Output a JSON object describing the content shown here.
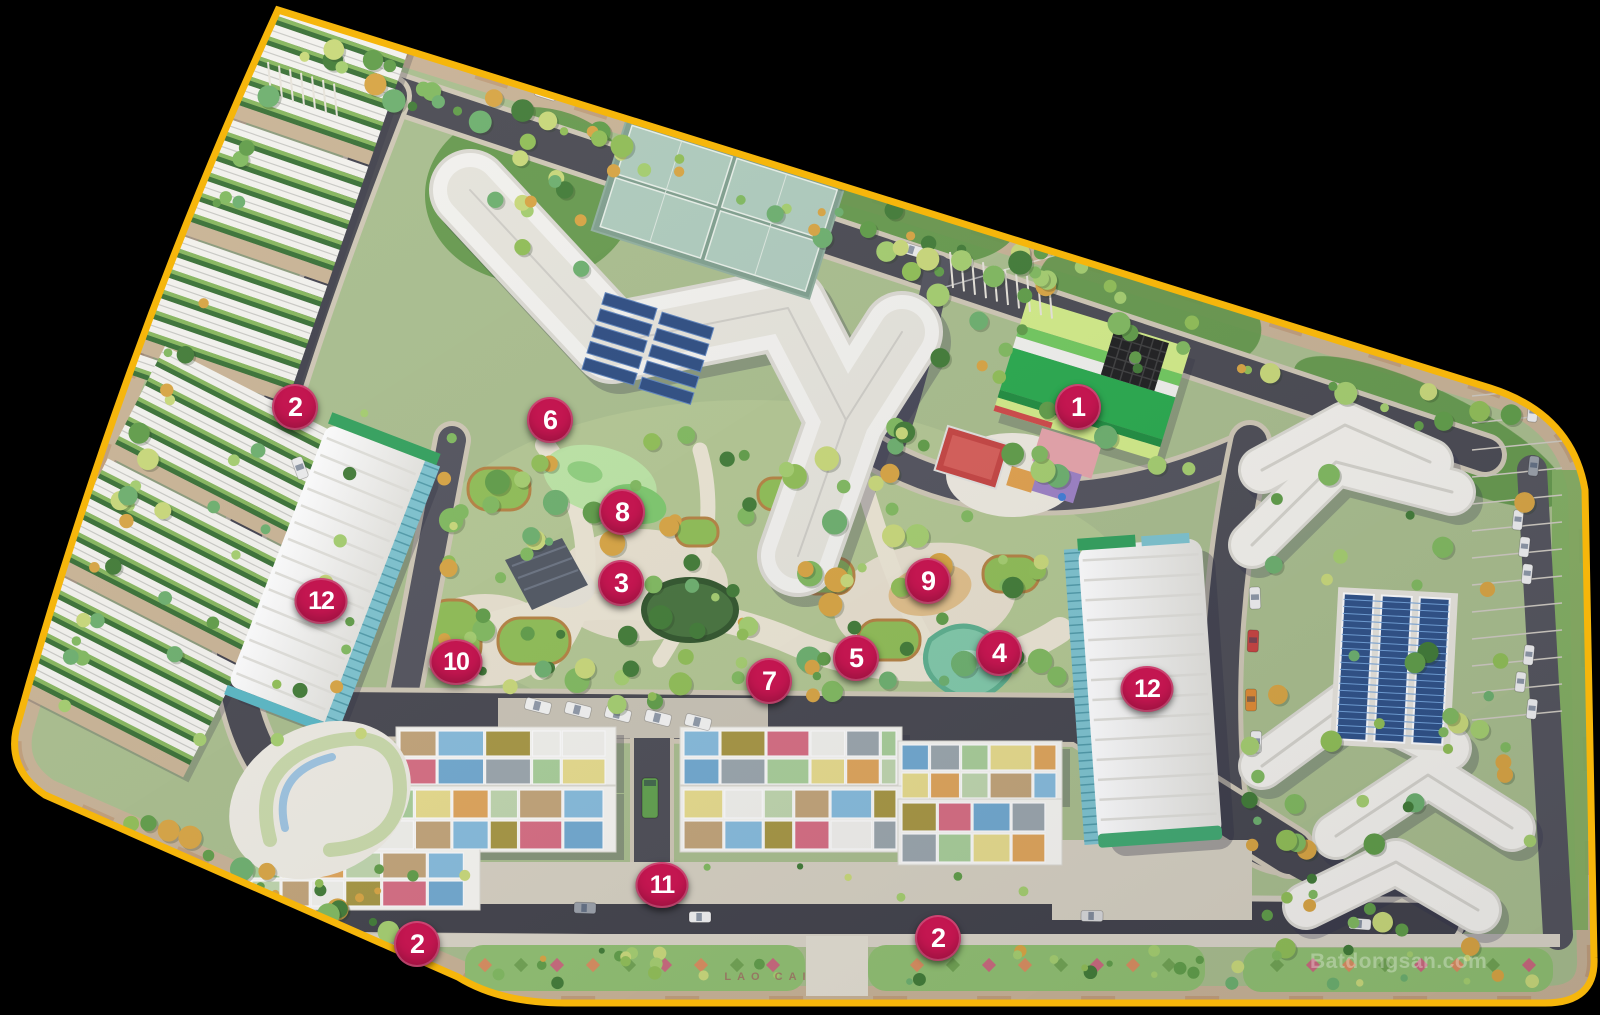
{
  "scene": {
    "description": "Aerial 3D masterplan of a residential complex outlined in yellow on black background",
    "background_color": "#000000"
  },
  "site_outline": {
    "border_color": "#F6B60B",
    "outside_color": "#000000"
  },
  "marker_style": {
    "background": "#C31650",
    "text_color": "#FFFFFF"
  },
  "markers": [
    {
      "label": "1",
      "x": 1078,
      "y": 407
    },
    {
      "label": "2",
      "x": 295,
      "y": 407
    },
    {
      "label": "2",
      "x": 417,
      "y": 944
    },
    {
      "label": "2",
      "x": 938,
      "y": 938
    },
    {
      "label": "3",
      "x": 621,
      "y": 583
    },
    {
      "label": "4",
      "x": 999,
      "y": 653
    },
    {
      "label": "5",
      "x": 856,
      "y": 658
    },
    {
      "label": "6",
      "x": 550,
      "y": 420
    },
    {
      "label": "7",
      "x": 769,
      "y": 681
    },
    {
      "label": "8",
      "x": 622,
      "y": 512
    },
    {
      "label": "9",
      "x": 928,
      "y": 581
    },
    {
      "label": "10",
      "x": 456,
      "y": 662
    },
    {
      "label": "11",
      "x": 662,
      "y": 885
    },
    {
      "label": "12",
      "x": 321,
      "y": 601
    },
    {
      "label": "12",
      "x": 1147,
      "y": 689
    }
  ],
  "watermark": {
    "text": "Batdongsan.com",
    "x": 1310,
    "y": 950
  },
  "median_text": {
    "text": "LAO CAI",
    "x": 768,
    "y": 977
  }
}
